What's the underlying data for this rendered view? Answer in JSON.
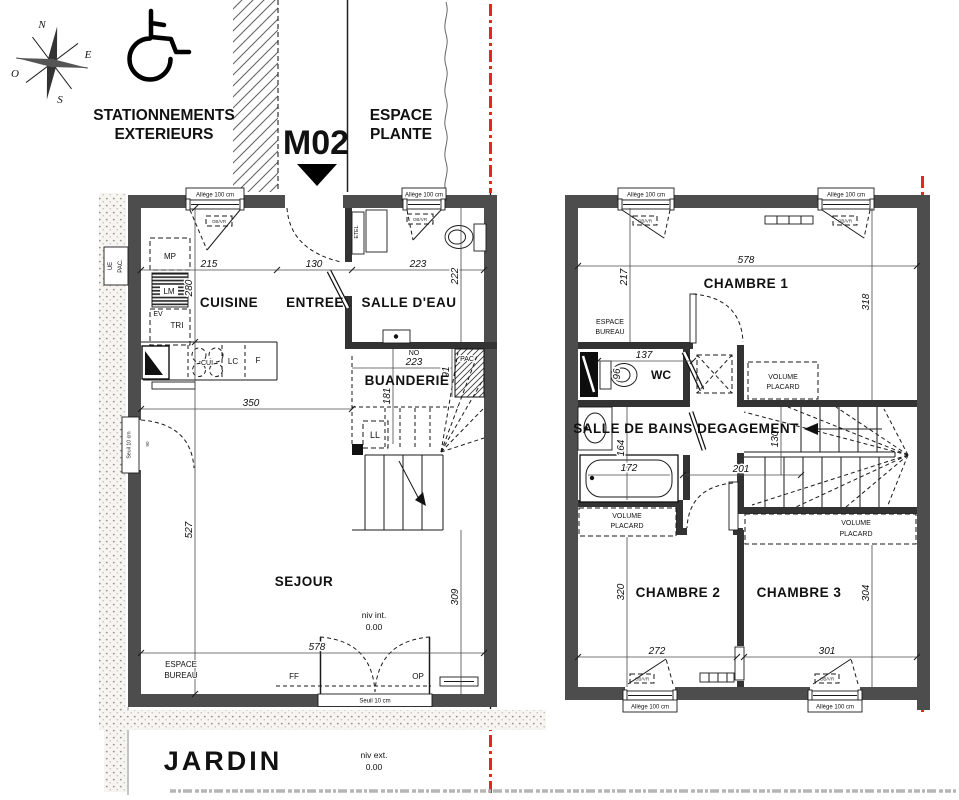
{
  "colors": {
    "wall": "#4d4d4d",
    "interior_wall": "#333333",
    "line": "#1a1a1a",
    "boundary_red": "#e8261f",
    "paper": "#ffffff"
  },
  "site": {
    "compass_n": "N",
    "compass_e": "E",
    "compass_s": "S",
    "compass_o": "O",
    "parking_1": "STATIONNEMENTS",
    "parking_2": "EXTERIEURS",
    "unit": "M02",
    "plante_1": "ESPACE",
    "plante_2": "PLANTE",
    "jardin": "JARDIN",
    "niv_ext_1": "niv ext.",
    "niv_ext_2": "0.00"
  },
  "gf": {
    "rooms": {
      "cuisine": "CUISINE",
      "entree": "ENTREE",
      "salle_eau": "SALLE D'EAU",
      "buanderie": "BUANDERIE",
      "sejour": "SEJOUR"
    },
    "fixtures": {
      "mp": "MP",
      "lm": "LM",
      "ev": "EV",
      "tri": "TRI",
      "cui": "CUI",
      "lc": "LC",
      "f": "F",
      "ll": "LL",
      "no": "NO",
      "pac": "PAC",
      "etel": "ETEL",
      "ue_pac_1": "UE",
      "ue_pac_2": "PAC.",
      "ff": "FF",
      "op": "OP"
    },
    "espace": "ESPACE",
    "bureau": "BUREAU",
    "allege": "Allège 100 cm",
    "obvr": "OB/VR",
    "seuil": "Seuil 10 cm",
    "niv_int_1": "niv int.",
    "niv_int_2": "0.00",
    "dims": {
      "d215": "215",
      "d130": "130",
      "d223a": "223",
      "d280": "280",
      "d222": "222",
      "d350": "350",
      "d223b": "223",
      "d91": "91",
      "d181": "181",
      "d527": "527",
      "d309": "309",
      "d578": "578",
      "d90": "90"
    }
  },
  "ff": {
    "rooms": {
      "ch1": "CHAMBRE 1",
      "ch2": "CHAMBRE 2",
      "ch3": "CHAMBRE 3",
      "sdb": "SALLE DE BAINS",
      "deg": "DEGAGEMENT",
      "wc": "WC"
    },
    "espace": "ESPACE",
    "bureau": "BUREAU",
    "volume": "VOLUME",
    "placard": "PLACARD",
    "allege": "Allège 100 cm",
    "obvr": "OB/VR",
    "dims": {
      "d578": "578",
      "d217": "217",
      "d318": "318",
      "d137": "137",
      "d96": "96",
      "d164": "164",
      "d172": "172",
      "d130": "130",
      "d201": "201",
      "d320": "320",
      "d304": "304",
      "d272": "272",
      "d301": "301"
    }
  }
}
